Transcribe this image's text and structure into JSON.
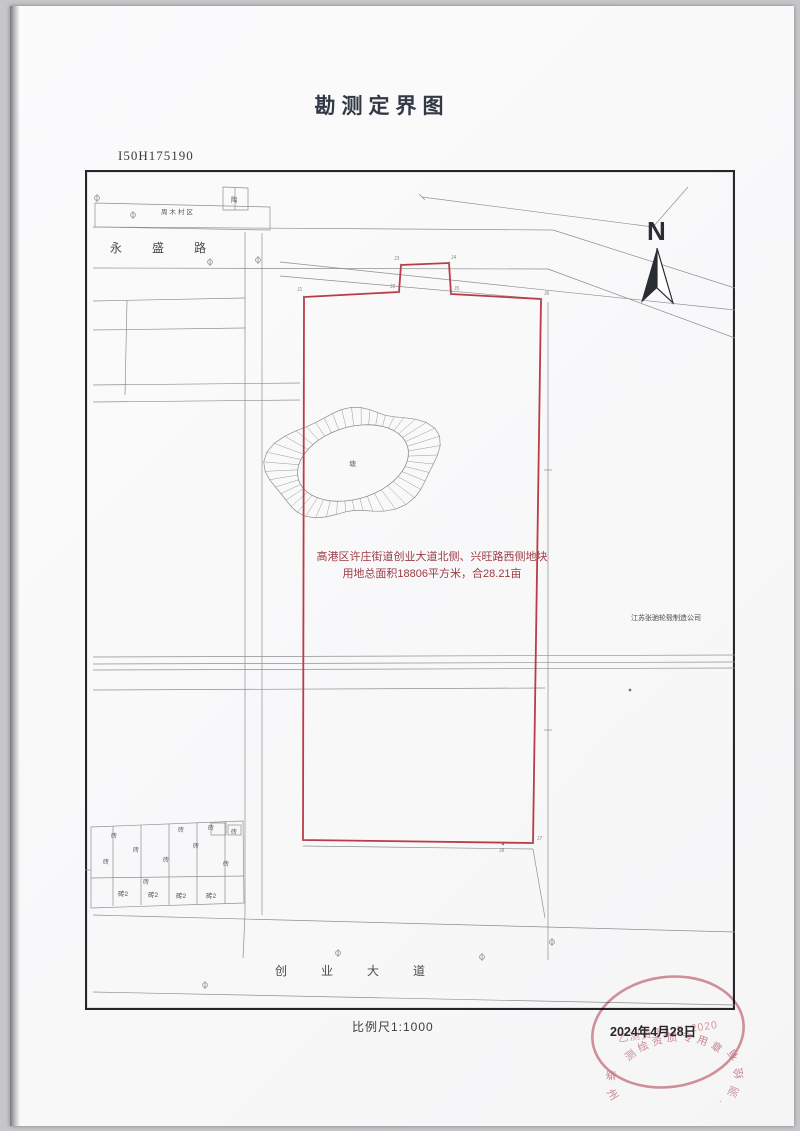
{
  "page": {
    "title": "勘测定界图",
    "sheet_code": "I50H175190",
    "scale_label": "比例尺1:1000",
    "date": "2024年4月28日"
  },
  "map": {
    "north_label": "N",
    "road_top": "永盛路",
    "road_bottom": "创业大道",
    "village_label": "周木村区",
    "hut_label": "陶",
    "pond_label": "塘",
    "parcel_text_line1": "高港区许庄街道创业大道北侧、兴旺路西侧地块",
    "parcel_text_line2": "用地总面积18806平方米，合28.21亩",
    "company_label": "江苏张驰轮毂制造公司",
    "brick_label": "砖",
    "brick2_label": "砖2",
    "boundary_points": [
      "J1",
      "J2",
      "J3",
      "J4",
      "J5",
      "J6",
      "J7",
      "J8"
    ]
  },
  "stamp": {
    "company_arc": "泰州市高港房地产测绘有限公司",
    "cert_no": "乙测资字32512020",
    "seal_type": "测绘资质专用章"
  },
  "colors": {
    "boundary_red": "#bb3b46",
    "parcel_text_red": "#9c3a42",
    "stamp_red": "#c4606e",
    "line_gray": "#8f8f8f",
    "frame_black": "#24262b"
  }
}
